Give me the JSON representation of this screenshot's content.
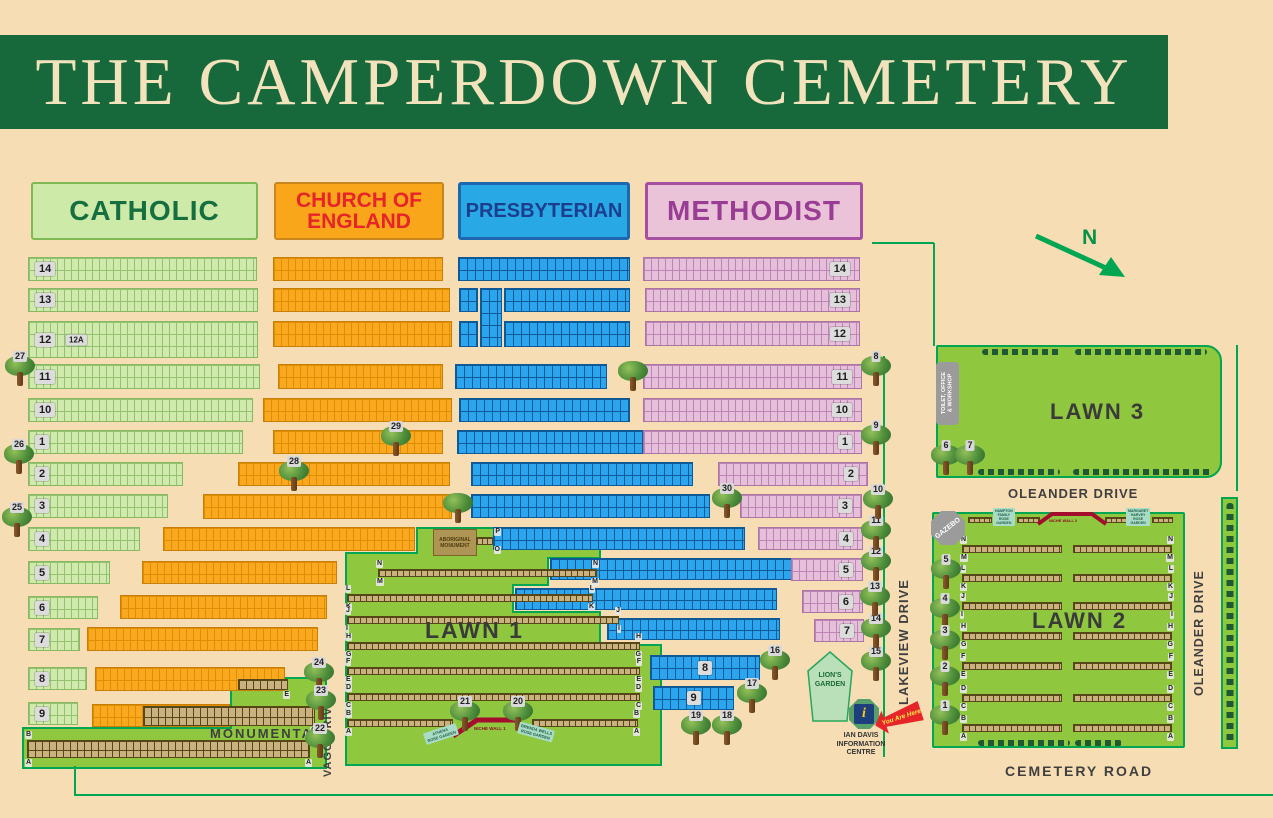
{
  "title": "THE CAMPERDOWN CEMETERY",
  "north_label": "N",
  "section_headers": {
    "catholic": "CATHOLIC",
    "church_of_england": "CHURCH OF ENGLAND",
    "presbyterian": "PRESBYTERIAN",
    "methodist": "METHODIST"
  },
  "catholic_rows": [
    "14",
    "13",
    "12",
    "11",
    "10",
    "1",
    "2",
    "3",
    "4",
    "5",
    "6",
    "7",
    "8",
    "9"
  ],
  "catholic_row_12a": "12A",
  "methodist_rows": [
    "14",
    "13",
    "12",
    "11",
    "10",
    "1",
    "2",
    "3",
    "4",
    "5",
    "6",
    "7"
  ],
  "presbyterian_blocks": [
    "8",
    "9"
  ],
  "monumental": {
    "label": "MONUMENTAL",
    "letters": {
      "e": "E",
      "d": "D",
      "c": "C",
      "b": "B",
      "a": "A"
    }
  },
  "roads": {
    "vagg": "VAGG DRIVE",
    "lakeview": "LAKEVIEW DRIVE",
    "oleander_top": "OLEANDER DRIVE",
    "oleander_side": "OLEANDER DRIVE",
    "cemetery": "CEMETERY ROAD"
  },
  "lawn1": {
    "label": "LAWN 1",
    "niche_wall": "NICHE WALL 1",
    "rows": [
      [
        "P",
        "O"
      ],
      [
        "N",
        "M"
      ],
      [
        "L",
        "K"
      ],
      [
        "J",
        "I"
      ],
      [
        "H",
        "G"
      ],
      [
        "F",
        "E"
      ],
      [
        "D",
        "C"
      ],
      [
        "B",
        "A"
      ]
    ],
    "athena_lines": [
      "ATHENA",
      "ROSE GARDEN"
    ],
    "brenda_lines": [
      "BRENDA WELLS",
      "ROSE GARDEN"
    ]
  },
  "lawn2": {
    "label": "LAWN 2",
    "niche_wall": "NICHE WALL 2",
    "gazebo": "GAZEBO",
    "rows": [
      [
        "N",
        "M"
      ],
      [
        "L",
        "K"
      ],
      [
        "J",
        "I"
      ],
      [
        "H",
        "G"
      ],
      [
        "F",
        "E"
      ],
      [
        "D",
        "C"
      ],
      [
        "B",
        "A"
      ]
    ],
    "hampton_lines": [
      "HAMPTON",
      "FAMILY",
      "ROSE",
      "GARDEN"
    ],
    "margaret_lines": [
      "MARGARET",
      "HARVEY",
      "ROSE",
      "GARDEN"
    ]
  },
  "lawn3": {
    "label": "LAWN 3",
    "toilet_lines": [
      "TOILET, OFFICE",
      "& WORKSHOP"
    ]
  },
  "aboriginal_monument_lines": [
    "ABORIGINAL",
    "MONUMENT"
  ],
  "lions_garden_lines": [
    "LION'S",
    "GARDEN"
  ],
  "info_centre": {
    "lines": [
      "IAN DAVIS",
      "INFORMATION",
      "CENTRE"
    ],
    "icon_glyph": "i",
    "you_are_here": "You Are Here"
  },
  "trees": {
    "t1": "1",
    "t2": "2",
    "t3": "3",
    "t4": "4",
    "t5": "5",
    "t6": "6",
    "t7": "7",
    "t8": "8",
    "t9": "9",
    "t10": "10",
    "t11": "11",
    "t12": "12",
    "t13": "13",
    "t14": "14",
    "t15": "15",
    "t16": "16",
    "t17": "17",
    "t18": "18",
    "t19": "19",
    "t20": "20",
    "t21": "21",
    "t22": "22",
    "t23": "23",
    "t24": "24",
    "t25": "25",
    "t26": "26",
    "t27": "27",
    "t28": "28",
    "t29": "29",
    "t30": "30"
  },
  "colors": {
    "background": "#F7DDB4",
    "header_bg": "#17693B",
    "catholic": "#CFEAAC",
    "church_of_england": "#FAA81F",
    "presbyterian": "#2BA5EE",
    "methodist": "#E6C0DA",
    "lawn_green": "#8FC73E",
    "road_line": "#00A651",
    "niche_wall": "#A50D2D"
  }
}
